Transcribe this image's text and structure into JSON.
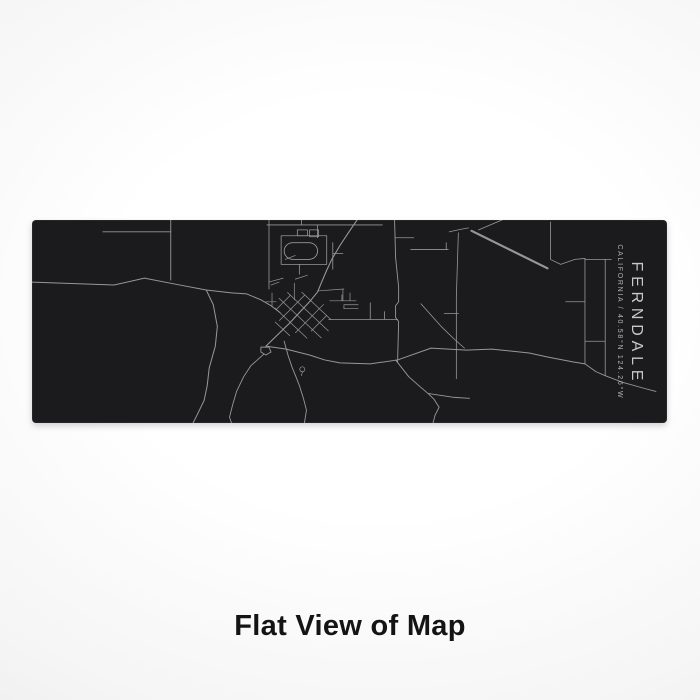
{
  "product_image": {
    "title": "FERNDALE",
    "subtitle": "CALIFORNIA / 40.58°N 124.26°W",
    "location": {
      "city": "FERNDALE",
      "state": "CALIFORNIA",
      "latitude": "40.58°N",
      "longitude": "124.26°W"
    }
  },
  "caption": {
    "label": "Flat View of Map"
  },
  "colors": {
    "map_background": "#1b1b1d",
    "road": "#979797",
    "map_text": "#c9c9c9",
    "map_subtext": "#b4b4b4",
    "caption_text": "#141414",
    "page_background": "#f2f2f2"
  },
  "map": {
    "style": "flat engraved line map",
    "roads": [
      {
        "d": "M137,0 V61",
        "w": 0.9
      },
      {
        "d": "M70,12 H137",
        "w": 0.9
      },
      {
        "d": "M0,63 L81,66 L111,59 L141,65 L172,71 L197,74 L212,75 L226,81 L236,87 L245,94",
        "w": 1
      },
      {
        "d": "M172,71 L179,86 L183,108 L181,128 L175,150 L173,168 L170,183 L162,200 L159,206",
        "w": 1
      },
      {
        "d": "M234,0 V70",
        "w": 0.8
      },
      {
        "d": "M232,5 H346",
        "w": 0.8
      },
      {
        "d": "M266,0 V5 M282,5 V18",
        "w": 0.8
      },
      {
        "d": "M246,16 H291 V45 H246 Z",
        "w": 0.8
      },
      {
        "d": "M257.5,23 h16 a8.5,8.5 0 0 1 0,17 h-16 a8.5,8.5 0 0 1 0,-17 Z",
        "w": 0.9
      },
      {
        "d": "M262,10 h10 v6 h-10 Z M274,10 h9 v7 h-9 Z",
        "w": 0.8
      },
      {
        "d": "M264,45 V55",
        "w": 0.8
      },
      {
        "d": "M321,0 L313,12 L304,26 L296,40 L291,51 L286,63 L282,73 L274,83 L254,105 L239,120 L231,128",
        "w": 1.1
      },
      {
        "d": "M297,23 V50 M297,34 H307",
        "w": 0.8
      },
      {
        "d": "M250,40 L260,36 M234,63 L248,59 M236,66 L244,63 M260,60 L272,56",
        "w": 0.7
      },
      {
        "d": "M294,82 H320 M306,82 V76 M314,82 V74",
        "w": 0.7
      },
      {
        "d": "M308,86 H322 M308,90 H322 M308,86 V90",
        "w": 0.7
      },
      {
        "d": "M293,101 H361 M334,101 V84 M348,101 V93",
        "w": 0.8
      },
      {
        "d": "M358,0 L359,38 L362,68 L362,83 L359,87 L359,99 L362,103 L361,144",
        "w": 0.9
      },
      {
        "d": "M374,30 H411 M409,23 V30 M359,18 H377",
        "w": 0.8
      },
      {
        "d": "M421,13 L419,78 L419,136 L419,161 M412,12 Q420,10 431,8 M407,95 H421",
        "w": 0.8
      },
      {
        "d": "M434,11 L509,49",
        "w": 2.2
      },
      {
        "d": "M464,0 L441,10",
        "w": 0.9
      },
      {
        "d": "M512,2 V40 M512,40 L522,45 L536,40 L546,39",
        "w": 0.8
      },
      {
        "d": "M546,39 V146 M527,83 H546 M546,123 H566",
        "w": 0.8
      },
      {
        "d": "M566,40 V158 M546,40 H572",
        "w": 0.8
      },
      {
        "d": "M546,146 L557,154 L566,158 L584,165 L605,171 L616,174",
        "w": 0.9
      },
      {
        "d": "M231,128 L251,131 L274,137 L289,142 L304,145 L334,146 L361,142 L394,130 L429,132 L454,131 L491,135 L509,139 L534,144 L546,146",
        "w": 1
      },
      {
        "d": "M359,142 L372,159 L383,169 L391,176 L397,182 L402,190 L398,198 L396,206 M391,176 L417,180 L432,181",
        "w": 0.9
      },
      {
        "d": "M226,129 L234,129 L236,134 L231,137 L226,134 Z M229,136 L216,148 L209,159 L202,174 L198,188 L195,200 L197,206",
        "w": 0.9
      },
      {
        "d": "M249,123 L253,138 L257,150 L261,160 L264,168 L268,181 L271,193 L269,206",
        "w": 0.9
      },
      {
        "d": "M267,149 a2.5,2.5 0 1 1 -0.2,0 M267,154 L266,158",
        "w": 0.7
      },
      {
        "d": "M282,72 L308,70 M307,70 V82",
        "w": 0.7
      },
      {
        "d": "M384,85 L404,108 L416,120 L427,130",
        "w": 0.8
      },
      {
        "d": "M259,64 V81 M237,74 V88 M231,83 H241",
        "w": 0.7
      }
    ],
    "downtown_grid": {
      "angle": 44,
      "cx": 264,
      "cy": 96,
      "lines": [
        "M254,78 V114",
        "M274,72 V112",
        "M284,78 V100",
        "M244,88 V108",
        "M250,78 H290",
        "M240,88 H296",
        "M238,98 H296",
        "M242,108 H286",
        "M252,118 H272"
      ]
    }
  }
}
